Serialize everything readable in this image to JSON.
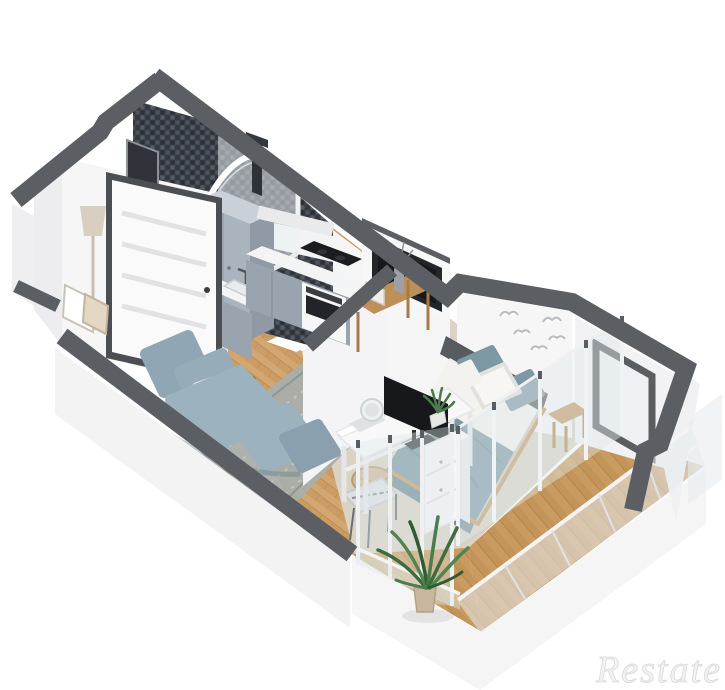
{
  "meta": {
    "kind": "3d-isometric-floor-plan-render",
    "width_px": 725,
    "height_px": 690
  },
  "watermark": {
    "text": "Restate"
  },
  "palette": {
    "background": "#ffffff",
    "wall_top": "#5b5f64",
    "wall_face_white": "#f4f4f5",
    "mosaic_tile": "#3a3f47",
    "wood_floor": "#d3a771",
    "balcony_wood": "#c99b60",
    "bedroom_floor": "#d9d2c5",
    "cabinet_gray": "#a9b4bf",
    "kitchen_front_gray": "#99a4af",
    "counter_white": "#f3f4f5",
    "sofa_blue_gray": "#90a6b4",
    "bed_blanket_teal": "#7d98a2",
    "bed_sheet_white": "#f3f2ef",
    "headboard_dark": "#565b60",
    "wood_furniture": "#bc9058",
    "rug_gray": "#a9aeaa",
    "screen_black": "#16181c",
    "plant_green": "#3e6b3f",
    "glass_tint": "#dfe8ec",
    "watermark_gray": "#f2f2f2"
  },
  "scene": {
    "rooms": [
      {
        "name": "hallway",
        "items": [
          "entry-door",
          "floor-lamp",
          "picture-frames"
        ]
      },
      {
        "name": "bathroom",
        "items": [
          "mosaic-walls",
          "corner-shower",
          "shower-column",
          "vanity-unit",
          "toilet",
          "wall-mirror"
        ]
      },
      {
        "name": "kitchen",
        "items": [
          "tall-cabinet",
          "base-cabinets-left",
          "base-cabinets-right",
          "countertop",
          "cooktop",
          "oven",
          "sink",
          "faucet"
        ]
      },
      {
        "name": "living-area",
        "items": [
          "sofa",
          "back-cushions",
          "accent-pillow",
          "rug",
          "media-wall",
          "tv",
          "console-table",
          "vase"
        ]
      },
      {
        "name": "bedroom",
        "items": [
          "double-bed",
          "headboard",
          "pillows",
          "teal-blanket",
          "bedside-stool",
          "birds-wall-decor",
          "desk",
          "monitor",
          "desk-chair",
          "drawer-unit",
          "storage-basket",
          "round-mirror",
          "desk-plant",
          "window-bay"
        ]
      },
      {
        "name": "balcony",
        "items": [
          "sliding-glass-doors",
          "glass-railing",
          "plank-floor",
          "palm-plant"
        ]
      }
    ]
  }
}
